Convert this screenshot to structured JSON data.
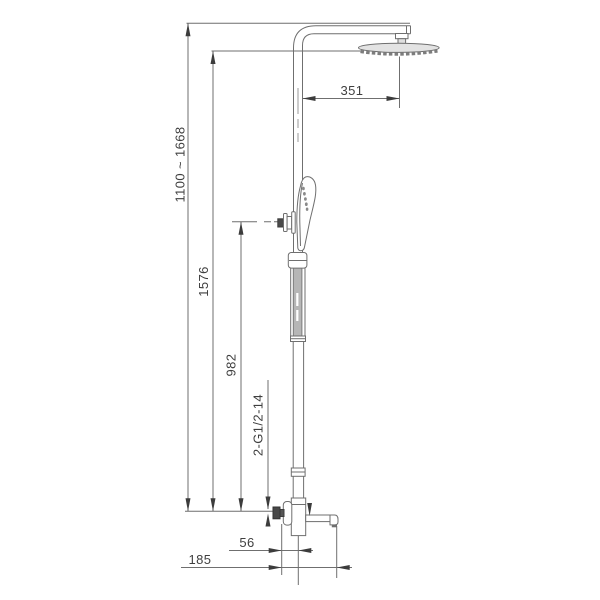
{
  "drawing": {
    "colors": {
      "line": "#6f6f6f",
      "arrow": "#3c3c3c",
      "text": "#3f3f3f",
      "fill_light": "#e3e3e3",
      "fill_mid": "#b6b6b6",
      "fill_dark": "#4a4a4a"
    },
    "dimensions": {
      "height_range": "1100 ~ 1668",
      "total_height": "1576",
      "hand_shower_height": "982",
      "thread_spec": "2-G1/2-14",
      "arm_reach": "351",
      "spout_offset": "56",
      "spout_reach": "185"
    }
  }
}
